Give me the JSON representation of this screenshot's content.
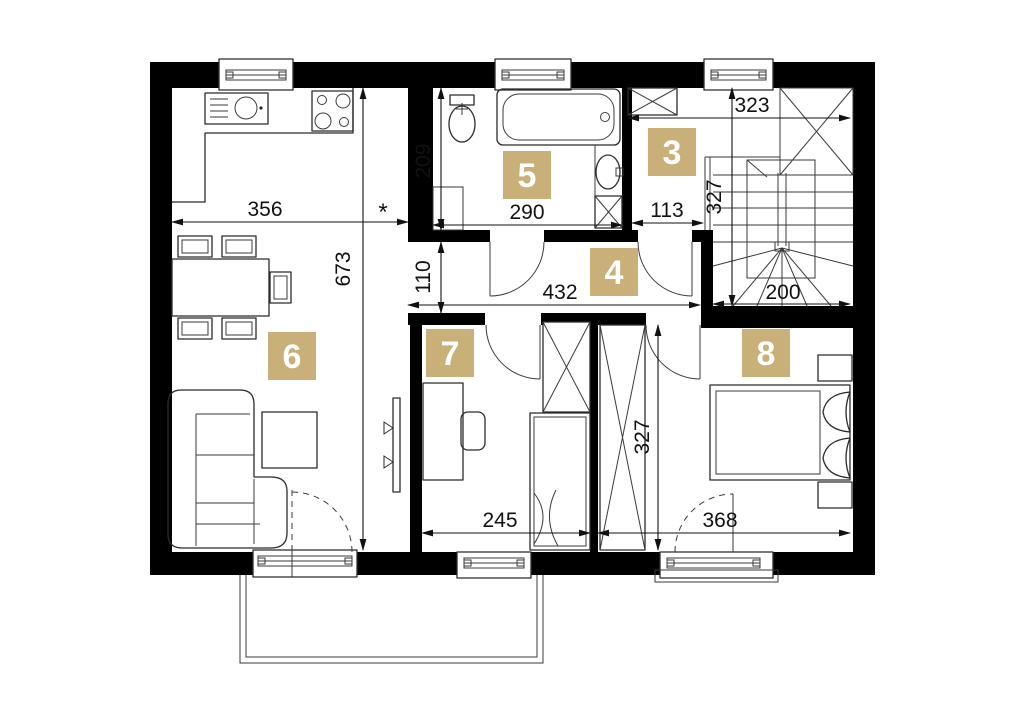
{
  "plan_title": "floor-plan-upper-storey",
  "colors": {
    "badge": "#C8B078",
    "badge_text": "#ffffff",
    "wall": "#000000",
    "line": "#2b2b2b",
    "dim_text": "#111111",
    "background": "#ffffff"
  },
  "rooms": [
    {
      "number": "3"
    },
    {
      "number": "4"
    },
    {
      "number": "5"
    },
    {
      "number": "6"
    },
    {
      "number": "7"
    },
    {
      "number": "8"
    }
  ],
  "dims": {
    "kitchen_width": "356",
    "footnote_marker": "*",
    "living_height": "673",
    "bath_height": "209",
    "bath_width": "290",
    "hall_width": "113",
    "stair_top_width": "323",
    "stair_height": "327",
    "stair_bottom_width": "200",
    "corridor_height": "110",
    "corridor_width": "432",
    "room7_width": "245",
    "rooms_height": "327",
    "room8_width": "368"
  }
}
